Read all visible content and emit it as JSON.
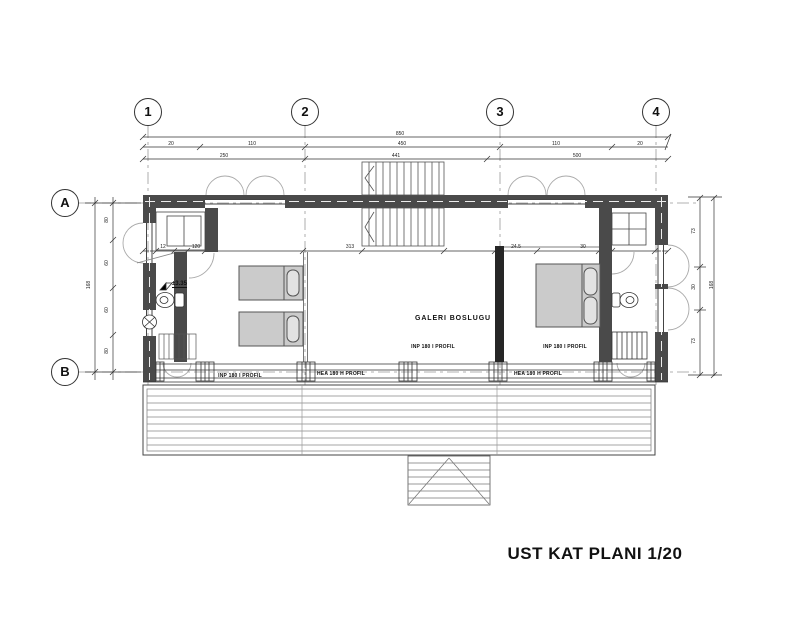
{
  "title": "UST KAT PLANI 1/20",
  "grid": {
    "columns": [
      "1",
      "2",
      "3",
      "4"
    ],
    "rows": [
      "A",
      "B"
    ]
  },
  "labels": {
    "gallery": "GALERI BOSLUGU",
    "level": "±3.35",
    "beam_inside_left": "INP 180 I PROFIL",
    "beam_inside_right": "INP 180 I PROFIL",
    "beam_bottom_left": "INP 180 I PROFIL",
    "beam_bottom_center": "HEA 180 H PROFIL",
    "beam_bottom_right": "HEA 180 H PROFIL"
  },
  "dimensions": {
    "top_total": "850",
    "top_row2": [
      "20",
      "110",
      "450",
      "110",
      "20"
    ],
    "top_row3": [
      "250",
      "441",
      "500"
    ],
    "interior": [
      "12",
      "120",
      "313",
      "24.5",
      "30"
    ],
    "left_inner": [
      "80",
      "60",
      "60",
      "80"
    ],
    "left_total": "168",
    "right_inner": [
      "73",
      "30",
      "73"
    ],
    "right_total": "168"
  },
  "colors": {
    "wall": "#4a4a4a",
    "line": "#333333",
    "bed_fill": "#cbcbcb",
    "gallery_wall": "#262626",
    "background": "#ffffff"
  }
}
